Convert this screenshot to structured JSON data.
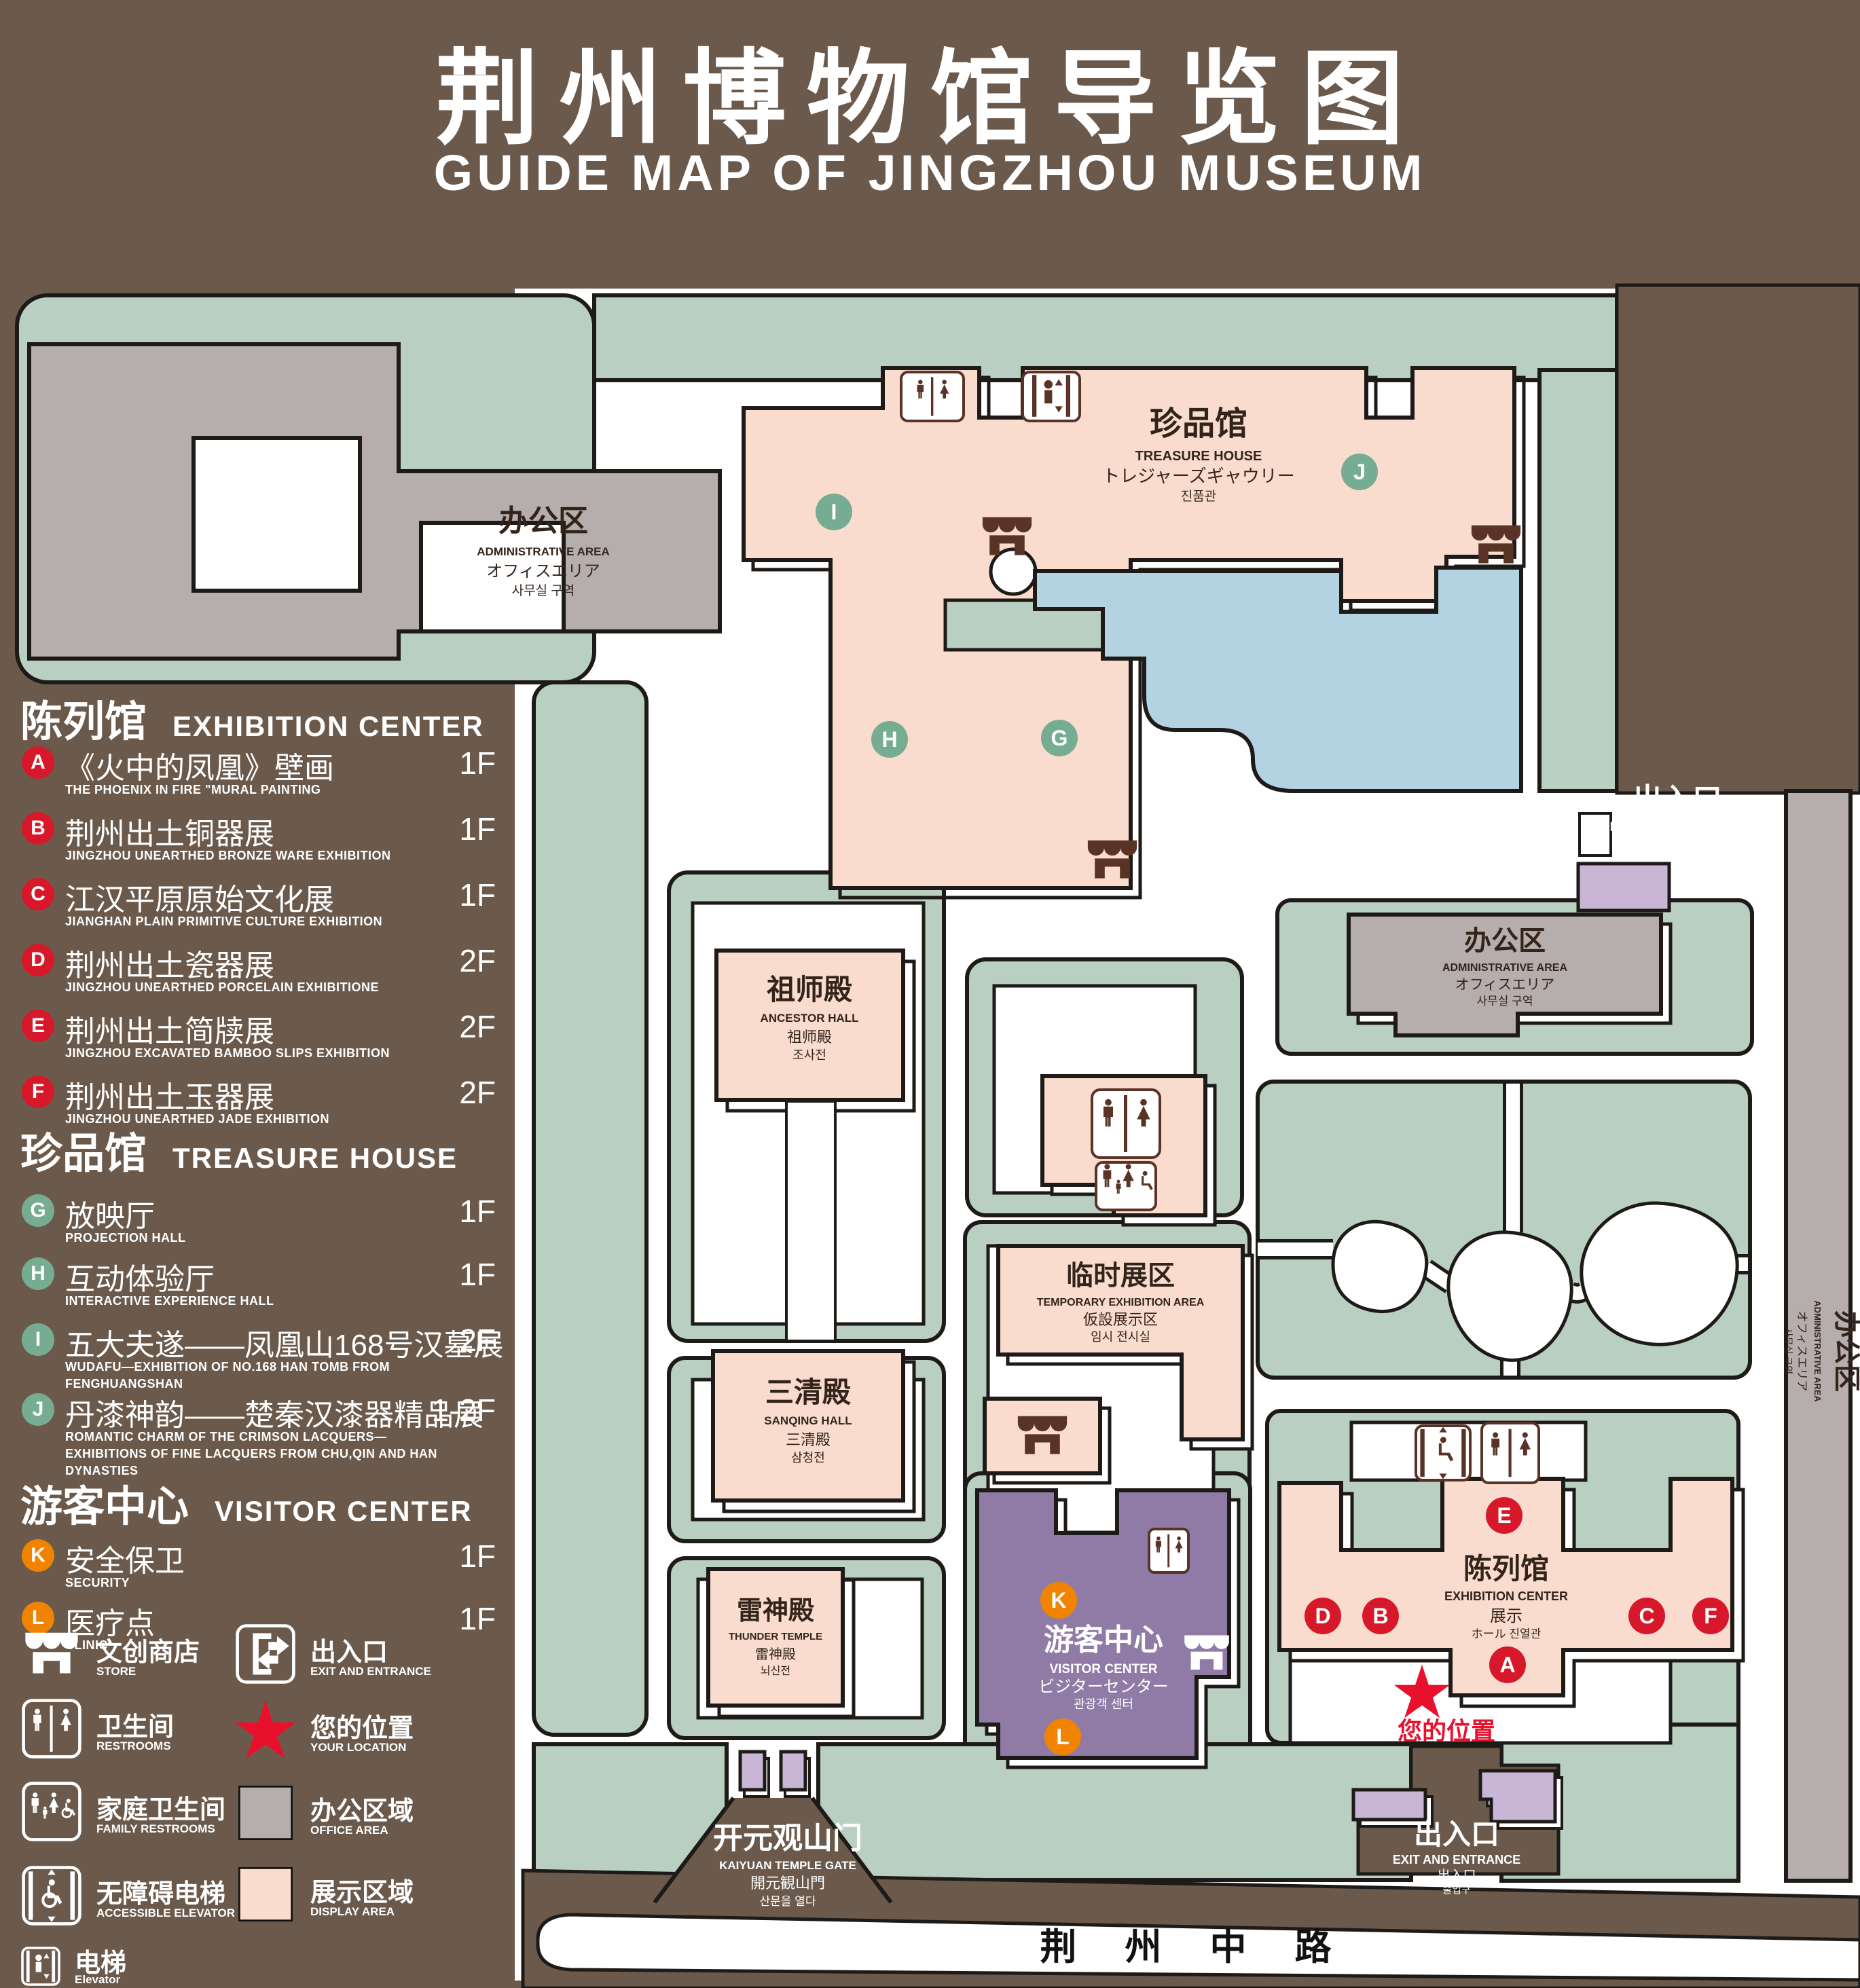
{
  "title": {
    "cn": "荆州博物馆导览图",
    "en": "GUIDE MAP OF JINGZHOU MUSEUM"
  },
  "colors": {
    "background": "#6b5a4c",
    "green_area": "#b9cfc1",
    "display_area": "#f9dcce",
    "office_area": "#b6aeac",
    "pond": "#b3d3e3",
    "visitor_purple": "#8f7ba6",
    "light_purple": "#c9b6d6",
    "marker_red": "#d7182a",
    "marker_green": "#76ad92",
    "marker_orange": "#f08300",
    "icon_brown": "#5a3327",
    "location_red": "#e8112d"
  },
  "legend": {
    "sections": [
      {
        "title_cn": "陈列馆",
        "title_en": "EXHIBITION CENTER",
        "items": [
          {
            "letter": "A",
            "cn": "《火中的凤凰》壁画",
            "en": "THE PHOENIX IN FIRE \"MURAL PAINTING",
            "floor": "1F"
          },
          {
            "letter": "B",
            "cn": "荆州出土铜器展",
            "en": "JINGZHOU UNEARTHED BRONZE WARE EXHIBITION",
            "floor": "1F"
          },
          {
            "letter": "C",
            "cn": "江汉平原原始文化展",
            "en": "JIANGHAN PLAIN PRIMITIVE CULTURE EXHIBITION",
            "floor": "1F"
          },
          {
            "letter": "D",
            "cn": "荆州出土瓷器展",
            "en": "JINGZHOU UNEARTHED PORCELAIN EXHIBITIONE",
            "floor": "2F"
          },
          {
            "letter": "E",
            "cn": "荆州出土简牍展",
            "en": "JINGZHOU EXCAVATED BAMBOO SLIPS EXHIBITION",
            "floor": "2F"
          },
          {
            "letter": "F",
            "cn": "荆州出土玉器展",
            "en": "JINGZHOU UNEARTHED JADE EXHIBITION",
            "floor": "2F"
          }
        ]
      },
      {
        "title_cn": "珍品馆",
        "title_en": "TREASURE HOUSE",
        "items": [
          {
            "letter": "G",
            "cn": "放映厅",
            "en": "PROJECTION HALL",
            "floor": "1F"
          },
          {
            "letter": "H",
            "cn": "互动体验厅",
            "en": "INTERACTIVE EXPERIENCE HALL",
            "floor": "1F"
          },
          {
            "letter": "I",
            "cn": "五大夫遂——凤凰山168号汉墓展",
            "en": "WUDAFU—EXHIBITION OF NO.168 HAN TOMB FROM FENGHUANGSHAN",
            "floor": "2F"
          },
          {
            "letter": "J",
            "cn": "丹漆神韵——楚秦汉漆器精品展",
            "en": "ROMANTIC CHARM OF THE CRIMSON LACQUERS—EXHIBITIONS OF FINE LACQUERS FROM CHU,QIN AND HAN DYNASTIES",
            "floor": "1-2F"
          }
        ]
      },
      {
        "title_cn": "游客中心",
        "title_en": "VISITOR CENTER",
        "items": [
          {
            "letter": "K",
            "cn": "安全保卫",
            "en": "SECURITY",
            "floor": "1F"
          },
          {
            "letter": "L",
            "cn": "医疗点",
            "en": "CLINIC",
            "floor": "1F"
          }
        ]
      }
    ],
    "symbols_col1": [
      {
        "icon": "store-icon",
        "cn": "文创商店",
        "en": "STORE"
      },
      {
        "icon": "restrooms-icon",
        "cn": "卫生间",
        "en": "RESTROOMS"
      },
      {
        "icon": "family-restrooms-icon",
        "cn": "家庭卫生间",
        "en": "FAMILY RESTROOMS"
      },
      {
        "icon": "accessible-elevator-icon",
        "cn": "无障碍电梯",
        "en": "ACCESSIBLE ELEVATOR"
      },
      {
        "icon": "elevator-icon",
        "cn": "电梯",
        "en": "Elevator"
      }
    ],
    "symbols_col2": [
      {
        "icon": "exit-entrance-icon",
        "cn": "出入口",
        "en": "EXIT AND ENTRANCE"
      },
      {
        "icon": "your-location-icon",
        "cn": "您的位置",
        "en": "YOUR LOCATION"
      },
      {
        "icon": "office-area-swatch",
        "cn": "办公区域",
        "en": "OFFICE AREA"
      },
      {
        "icon": "display-area-swatch",
        "cn": "展示区域",
        "en": "DISPLAY AREA"
      }
    ]
  },
  "map": {
    "admin_nw": {
      "l1": "办公区",
      "l2": "ADMINISTRATIVE AREA",
      "l3": "オフィスエリア",
      "l4": "사무실 구역"
    },
    "treasure": {
      "l1": "珍品馆",
      "l2": "TREASURE HOUSE",
      "l3": "トレジャーズギャウリー",
      "l4": "진품관"
    },
    "ancestor": {
      "l1": "祖师殿",
      "l2": "ANCESTOR HALL",
      "l3": "祖师殿",
      "l4": "조사전"
    },
    "sanqing": {
      "l1": "三清殿",
      "l2": "SANQING HALL",
      "l3": "三清殿",
      "l4": "삼청전"
    },
    "thunder": {
      "l1": "雷神殿",
      "l2": "THUNDER TEMPLE",
      "l3": "雷神殿",
      "l4": "뇌신전"
    },
    "temporary": {
      "l1": "临时展区",
      "l2": "TEMPORARY EXHIBITION AREA",
      "l3": "仮設展示区",
      "l4": "임시 전시실"
    },
    "visitor": {
      "l1": "游客中心",
      "l2": "VISITOR CENTER",
      "l3": "ビジターセンター",
      "l4": "관광객 센터"
    },
    "exhibition": {
      "l1": "陈列馆",
      "l2": "EXHIBITION CENTER",
      "l3": "展示",
      "l4": "ホール 진열관"
    },
    "admin_mid": {
      "l1": "办公区",
      "l2": "ADMINISTRATIVE AREA",
      "l3": "オフィスエリア",
      "l4": "사무실 구역"
    },
    "admin_strip": {
      "l1": "办公区",
      "l2": "ADMINISTRATIVE AREA",
      "l3": "オフィスエリア",
      "l4": "사무실 구역"
    },
    "exit_ne": {
      "l1": "出入口",
      "l2": "EXIT AND ENTRANCE",
      "l3": "出入口",
      "l4": "출입구"
    },
    "exit_s": {
      "l1": "出入口",
      "l2": "EXIT AND ENTRANCE",
      "l3": "出入口",
      "l4": "출입구"
    },
    "gate": {
      "l1": "开元观山门",
      "l2": "KAIYUAN TEMPLE GATE",
      "l3": "開元観山門",
      "l4": "산문을 열다"
    },
    "road": "荆 州 中 路",
    "your_location": "您的位置",
    "markers": [
      {
        "letter": "A"
      },
      {
        "letter": "B"
      },
      {
        "letter": "C"
      },
      {
        "letter": "D"
      },
      {
        "letter": "E"
      },
      {
        "letter": "F"
      },
      {
        "letter": "G"
      },
      {
        "letter": "H"
      },
      {
        "letter": "I"
      },
      {
        "letter": "J"
      },
      {
        "letter": "K"
      },
      {
        "letter": "L"
      }
    ]
  }
}
